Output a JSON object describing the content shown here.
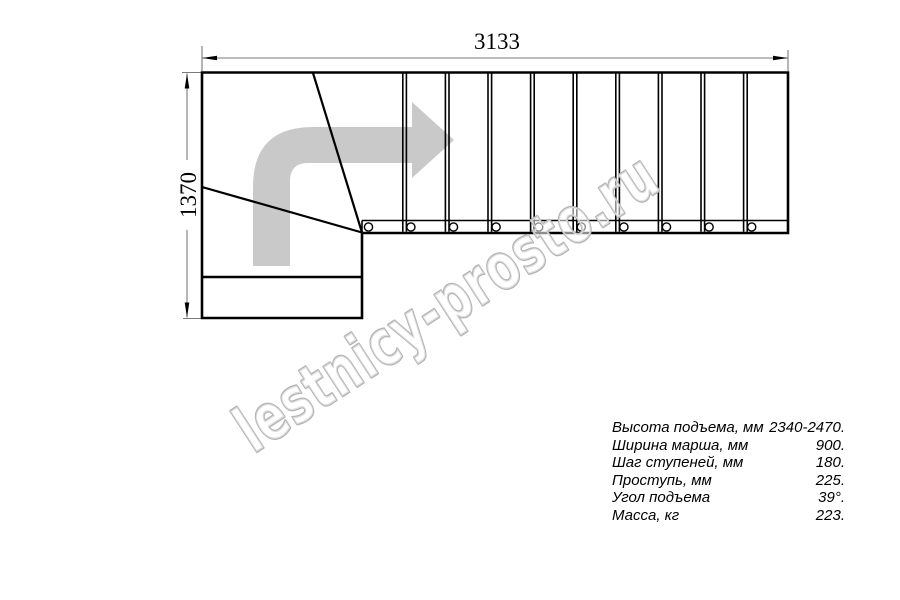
{
  "drawing": {
    "dimension_top": "3133",
    "dimension_left": "1370",
    "plan": {
      "straight_treads": 10,
      "winder_lines": 2,
      "baluster_circles": 10,
      "direction_arrow": "up-then-right"
    }
  },
  "specs": {
    "rows": [
      {
        "label": "Высота подъема, мм",
        "value": "2340-2470."
      },
      {
        "label": "Ширина марша, мм",
        "value": "900."
      },
      {
        "label": "Шаг ступеней, мм",
        "value": "180."
      },
      {
        "label": "Проступь, мм",
        "value": "225."
      },
      {
        "label": "Угол подъема",
        "value": "39°."
      },
      {
        "label": "Масса, кг",
        "value": "223."
      }
    ]
  },
  "watermark": {
    "text": "lestnicy-prosto.ru"
  },
  "colors": {
    "line": "#000000",
    "dimension_line": "#7a7a7a",
    "arrow_fill": "#c9c9c9",
    "watermark_outline": "#b3b3b3",
    "background": "#ffffff"
  }
}
